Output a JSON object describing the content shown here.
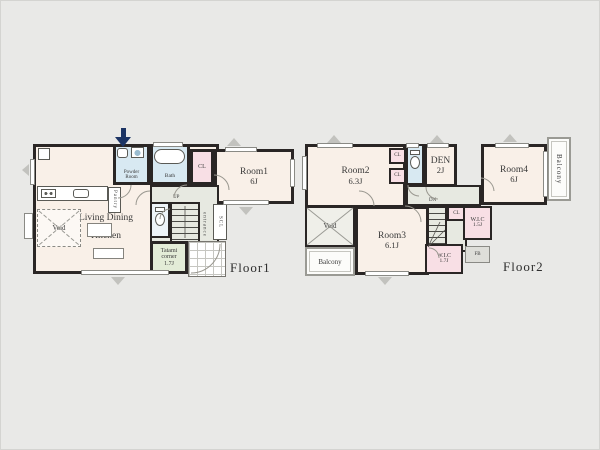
{
  "palette": {
    "canvas": "#e9e9e7",
    "wall": "#2a2625",
    "room_fill": "#f9f0e8",
    "wet_fill": "#d8e9f2",
    "closet_fill": "#f8dfe5",
    "hall_fill": "#e7e9e1",
    "tatami_fill": "#e3ecd7",
    "entry_arrow": "#1c3464"
  },
  "floor1": {
    "label": "Floor1",
    "ldk": {
      "line1": "Living Dining",
      "line2": "Kitchen",
      "size": "16.5J"
    },
    "tatami": {
      "line1": "Tatami",
      "line2": "corner",
      "size": "1.7J"
    },
    "room1": {
      "name": "Room1",
      "size": "6J"
    },
    "powder": {
      "line1": "Powder",
      "line2": "Room"
    },
    "bath": "Bath",
    "cl": "CL",
    "pantry": "Pantry",
    "void": "Void",
    "up": "UP",
    "entrance": "entrance",
    "scl": "SCL"
  },
  "floor2": {
    "label": "Floor2",
    "room2": {
      "name": "Room2",
      "size": "6.3J"
    },
    "room3": {
      "name": "Room3",
      "size": "6.1J"
    },
    "room4": {
      "name": "Room4",
      "size": "6J"
    },
    "den": {
      "name": "DEN",
      "size": "2J"
    },
    "cl_top": "CL",
    "cl_mid": "CL",
    "cl_stairs": "CL",
    "wic_right": {
      "name": "W.I.C",
      "size": "1.5J"
    },
    "wic_bottom": {
      "name": "W.I.C",
      "size": "1.7J"
    },
    "balcony_right": "Balcony",
    "balcony_left": "Balcony",
    "void": "Void",
    "dn": "DN",
    "fb": "FB"
  }
}
